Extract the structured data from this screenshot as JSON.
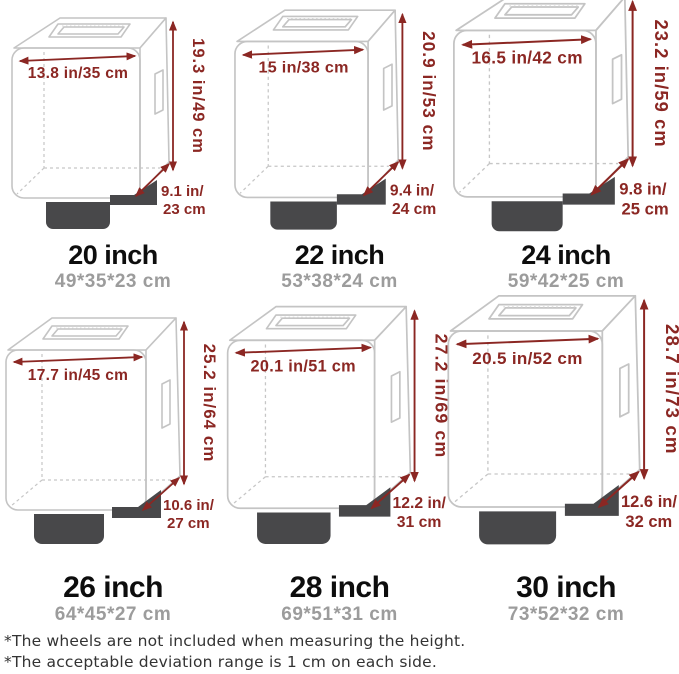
{
  "page": {
    "background": "#ffffff"
  },
  "colors": {
    "dimension_red": "#8b2723",
    "outline_gray": "#c4c4c4",
    "wheel_dark": "#48484a",
    "title_black": "#0d0d0d",
    "cm_gray": "#9c9c9c",
    "footnote_gray": "#333333"
  },
  "sizes": [
    {
      "name": "20 inch",
      "cm": "49*35*23 cm",
      "width": "13.8 in/35 cm",
      "height": "19.3 in/49 cm",
      "depth_line1": "9.1 in/",
      "depth_line2": "23 cm"
    },
    {
      "name": "22 inch",
      "cm": "53*38*24 cm",
      "width": "15 in/38 cm",
      "height": "20.9 in/53 cm",
      "depth_line1": "9.4 in/",
      "depth_line2": "24 cm"
    },
    {
      "name": "24 inch",
      "cm": "59*42*25 cm",
      "width": "16.5 in/42 cm",
      "height": "23.2 in/59 cm",
      "depth_line1": "9.8 in/",
      "depth_line2": "25 cm"
    },
    {
      "name": "26 inch",
      "cm": "64*45*27 cm",
      "width": "17.7 in/45 cm",
      "height": "25.2 in/64 cm",
      "depth_line1": "10.6 in/",
      "depth_line2": "27 cm"
    },
    {
      "name": "28 inch",
      "cm": "69*51*31 cm",
      "width": "20.1 in/51 cm",
      "height": "27.2 in/69 cm",
      "depth_line1": "12.2 in/",
      "depth_line2": "31 cm"
    },
    {
      "name": "30 inch",
      "cm": "73*52*32 cm",
      "width": "20.5 in/52 cm",
      "height": "28.7 in/73 cm",
      "depth_line1": "12.6 in/",
      "depth_line2": "32 cm"
    }
  ],
  "footnotes": {
    "line1": "*The wheels are not included when measuring the height.",
    "line2": "*The acceptable deviation range is 1 cm on each side."
  }
}
